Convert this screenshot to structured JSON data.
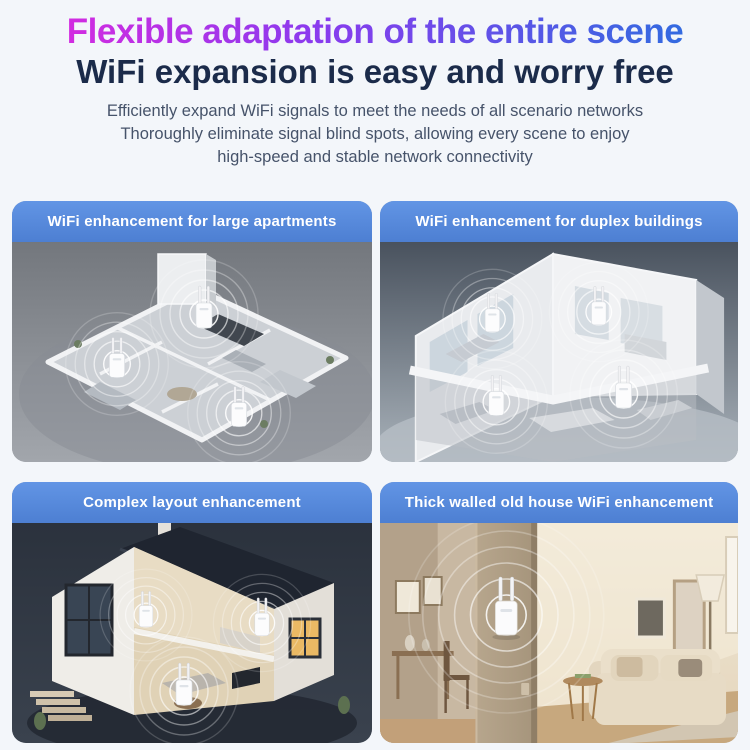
{
  "page": {
    "background_color": "#f3f6fa",
    "title": "Flexible adaptation of the entire scene",
    "title_gradient": [
      "#e128de",
      "#8a3bee",
      "#2a6fdf"
    ],
    "subtitle": "WiFi expansion is easy and worry free",
    "subtitle_color": "#1b2b4a",
    "description_lines": [
      "Efficiently expand WiFi signals to meet the needs of all scenario networks",
      "Thoroughly eliminate signal blind spots, allowing every scene to enjoy",
      "high-speed and stable network connectivity"
    ],
    "description_color": "#46536a"
  },
  "panel_style": {
    "band_gradient": [
      "#6295e5",
      "#4d7fd2"
    ],
    "label_text_color": "#ffffff"
  },
  "panels": [
    {
      "label": "WiFi enhancement for large apartments",
      "scene": "isometric large apartment floor plan, gray background, 3 wifi extenders with signal ripples",
      "scene_bg": "#8e9298"
    },
    {
      "label": "WiFi enhancement for duplex buildings",
      "scene": "isometric duplex two-story cutaway, slate background, 4 wifi extenders with signal ripples",
      "scene_bg": "#6e7884"
    },
    {
      "label": "Complex layout enhancement",
      "scene": "isometric two-story house cutaway with dark roof, dark navy background, 3 wifi extenders with signal ripples",
      "scene_bg": "#2f3843"
    },
    {
      "label": "Thick walled old house WiFi enhancement",
      "scene": "photo of beige living room, wifi extender mounted on thick wall column with large signal ripples, sofa at right",
      "scene_bg": "#e8dcc6"
    }
  ]
}
